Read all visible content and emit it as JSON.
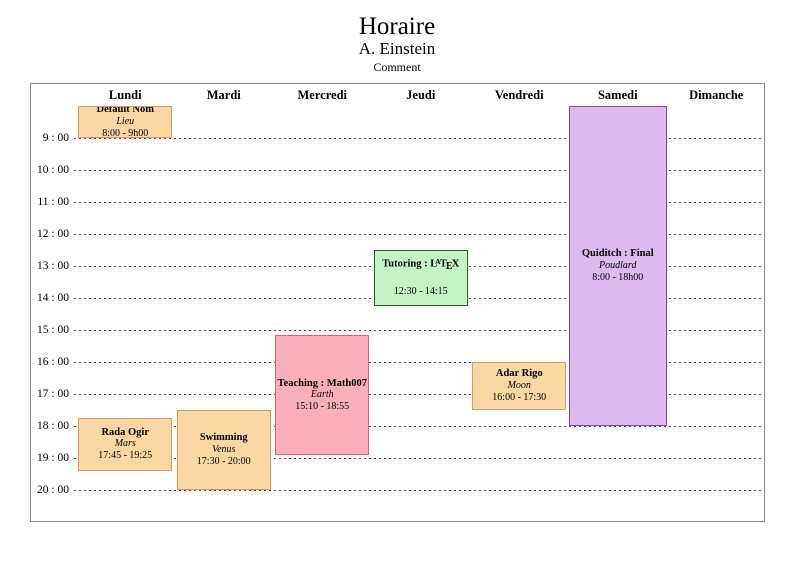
{
  "page": {
    "title": "Horaire",
    "subtitle": "A. Einstein",
    "comment": "Comment"
  },
  "colors": {
    "frame_border": "#8a8a8a",
    "gridline": "#4a4a4a",
    "text": "#000000"
  },
  "schedule": {
    "days": [
      "Lundi",
      "Mardi",
      "Mercredi",
      "Jeudi",
      "Vendredi",
      "Samedi",
      "Dimanche"
    ],
    "hour_labels": [
      "9 : 00",
      "10 : 00",
      "11 : 00",
      "12 : 00",
      "13 : 00",
      "14 : 00",
      "15 : 00",
      "16 : 00",
      "17 : 00",
      "18 : 00",
      "19 : 00",
      "20 : 00"
    ],
    "axis": {
      "grid_start_hour": 8,
      "first_label_hour": 9,
      "last_label_hour": 20,
      "line_style": "dashed"
    },
    "events": [
      {
        "id": "default-nom",
        "day": "Lundi",
        "day_index": 0,
        "title": "Default Nom",
        "location": "Lieu",
        "time_label": "8:00 - 9h00",
        "start_hour": 8.0,
        "end_hour": 9.0,
        "fill": "#FBD7A3",
        "border": "#D29C5A"
      },
      {
        "id": "rada-ogir",
        "day": "Lundi",
        "day_index": 0,
        "title": "Rada Ogir",
        "location": "Mars",
        "time_label": "17:45 - 19:25",
        "start_hour": 17.75,
        "end_hour": 19.4167,
        "fill": "#FBD7A3",
        "border": "#D29C5A"
      },
      {
        "id": "swimming",
        "day": "Mardi",
        "day_index": 1,
        "title": "Swimming",
        "location": "Venus",
        "time_label": "17:30 - 20:00",
        "start_hour": 17.5,
        "end_hour": 20.0,
        "fill": "#FBD7A3",
        "border": "#D29C5A"
      },
      {
        "id": "teaching-math007",
        "day": "Mercredi",
        "day_index": 2,
        "title": "Teaching : Math007",
        "location": "Earth",
        "time_label": "15:10 - 18:55",
        "start_hour": 15.1667,
        "end_hour": 18.9167,
        "fill": "#FBAFBC",
        "border": "#DE5F6E"
      },
      {
        "id": "tutoring-latex",
        "day": "Jeudi",
        "day_index": 3,
        "title": "Tutoring : LaTeX",
        "latex_logo": {
          "prefix": "Tutoring : ",
          "chars": [
            "L",
            "A",
            "T",
            "E",
            "X"
          ]
        },
        "location": "",
        "time_label": "12:30 - 14:15",
        "start_hour": 12.5,
        "end_hour": 14.25,
        "fill": "#C3F4C4",
        "border": "#1D651D"
      },
      {
        "id": "adar-rigo",
        "day": "Vendredi",
        "day_index": 4,
        "title": "Adar Rigo",
        "location": "Moon",
        "time_label": "16:00 - 17:30",
        "start_hour": 16.0,
        "end_hour": 17.5,
        "fill": "#FBD7A3",
        "border": "#D29C5A"
      },
      {
        "id": "quiditch-final",
        "day": "Samedi",
        "day_index": 5,
        "title": "Quiditch : Final",
        "location": "Poudlard",
        "time_label": "8:00 - 18h00",
        "start_hour": 8.0,
        "end_hour": 18.0,
        "fill": "#DDB9F2",
        "border": "#8348A8",
        "wide": true
      }
    ]
  }
}
